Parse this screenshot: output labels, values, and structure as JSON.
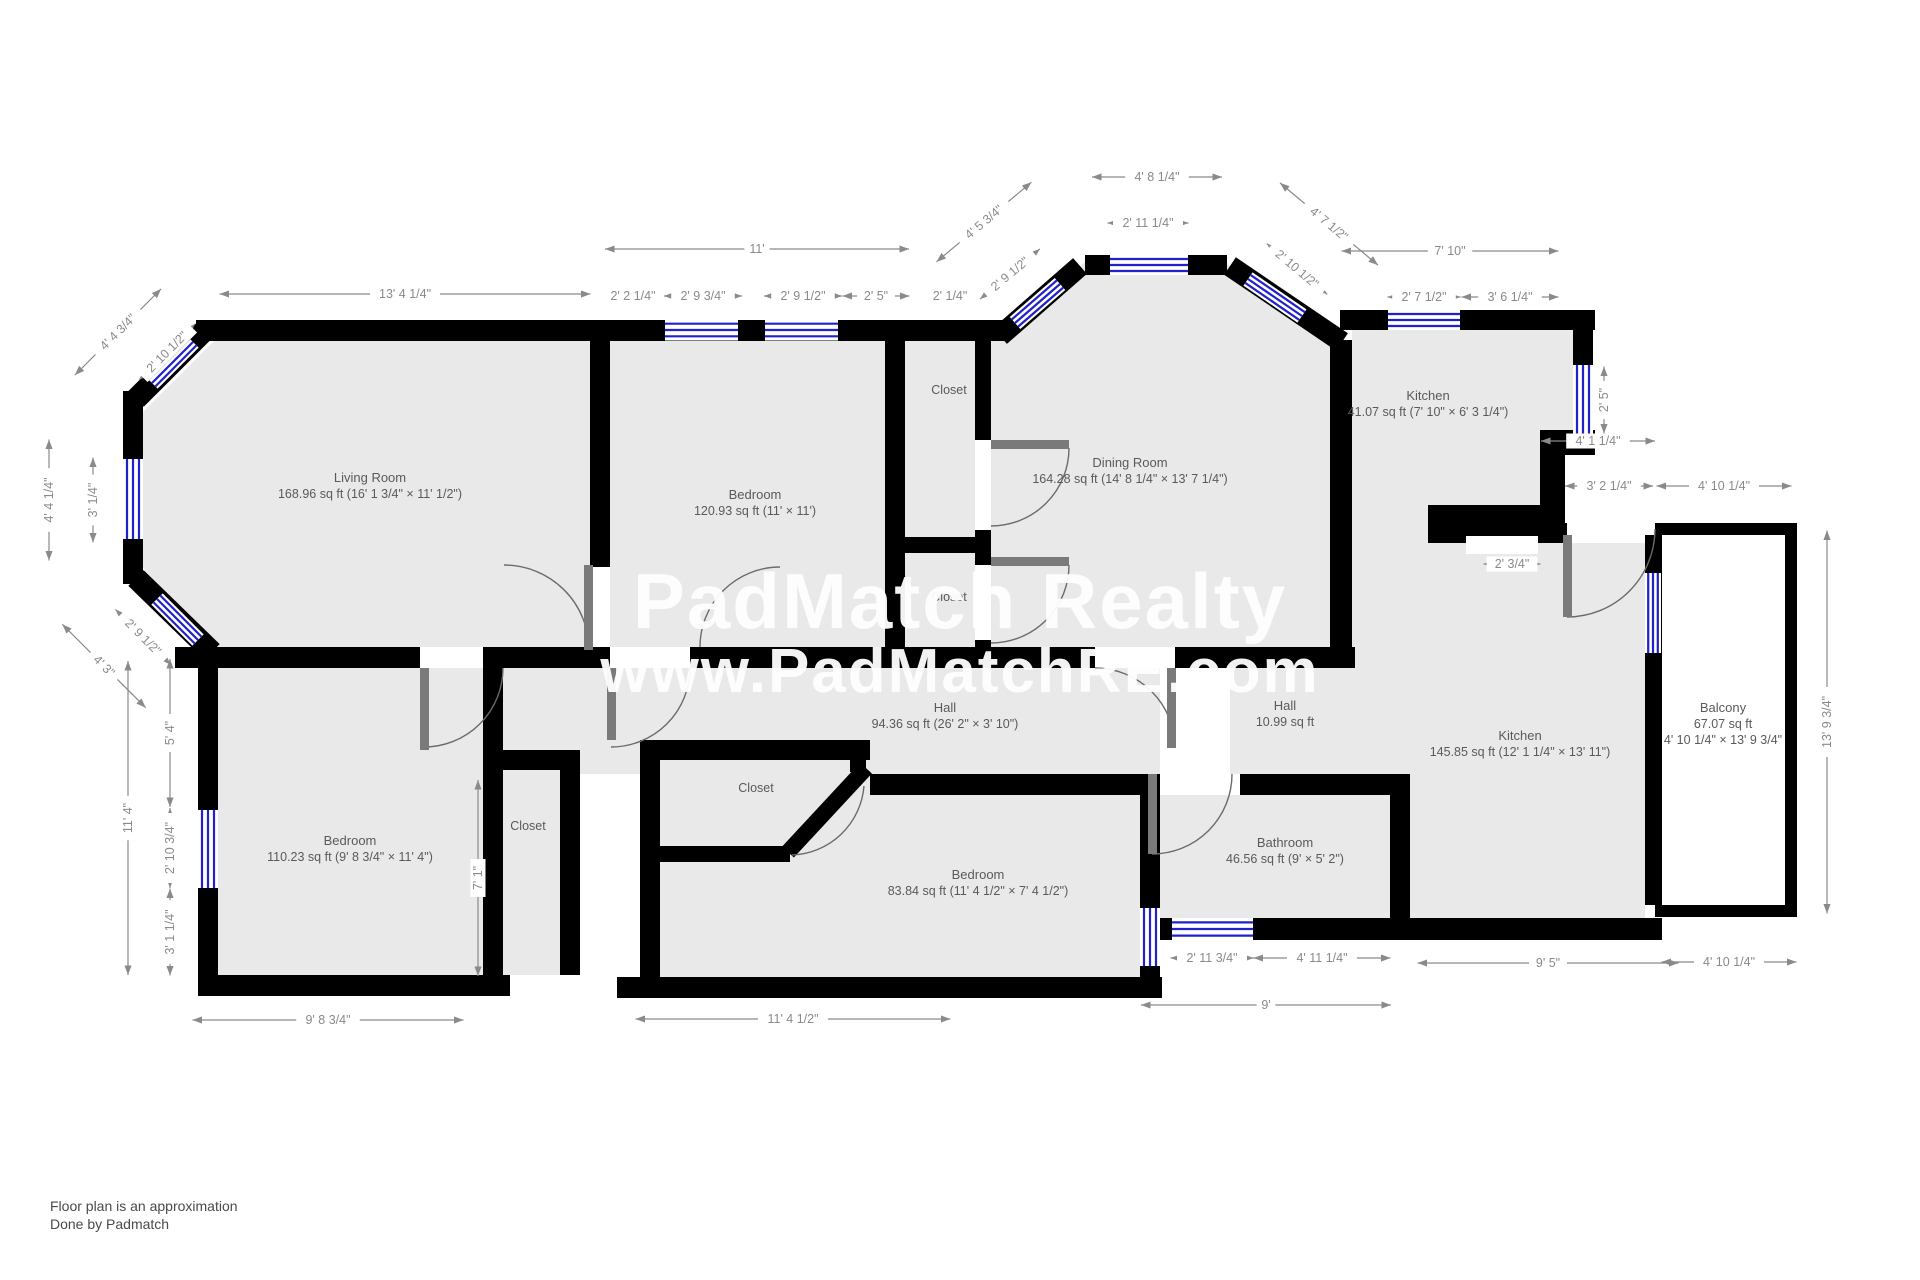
{
  "watermark": {
    "line1": "PadMatch Realty",
    "line2": "www.PadMatchRE.com"
  },
  "footer": {
    "line1": "Floor plan is an approximation",
    "line2": "Done by Padmatch"
  },
  "colors": {
    "wall": "#000000",
    "floor": "#e9e9e9",
    "window_blue": "#2121cc",
    "dimension_gray": "#8a8a8a",
    "label_gray": "#5a5a5a",
    "watermark_white": "#ffffff"
  },
  "rooms": [
    {
      "name": "Living Room",
      "area": "168.96 sq ft (16' 1 3/4\" × 11' 1/2\")",
      "x": 370,
      "y": 482
    },
    {
      "name": "Bedroom",
      "area": "120.93 sq ft (11' × 11')",
      "x": 755,
      "y": 499
    },
    {
      "name": "Dining Room",
      "area": "164.28 sq ft (14' 8 1/4\" × 13' 7 1/4\")",
      "x": 1130,
      "y": 467
    },
    {
      "name": "Kitchen",
      "area": "41.07 sq ft (7' 10\" × 6' 3 1/4\")",
      "x": 1428,
      "y": 400
    },
    {
      "name": "Kitchen",
      "area": "145.85 sq ft (12' 1 1/4\" × 13' 11\")",
      "x": 1520,
      "y": 740
    },
    {
      "name": "Balcony",
      "area": "67.07 sq ft",
      "area2": "4' 10 1/4\" × 13' 9 3/4\"",
      "x": 1723,
      "y": 712
    },
    {
      "name": "Hall",
      "area": "94.36 sq ft (26' 2\" × 3' 10\")",
      "x": 945,
      "y": 712
    },
    {
      "name": "Hall",
      "area": "10.99 sq ft",
      "x": 1285,
      "y": 710
    },
    {
      "name": "Bedroom",
      "area": "110.23 sq ft (9' 8 3/4\" × 11' 4\")",
      "x": 350,
      "y": 845
    },
    {
      "name": "Bedroom",
      "area": "83.84 sq ft (11' 4 1/2\" × 7' 4 1/2\")",
      "x": 978,
      "y": 879
    },
    {
      "name": "Bathroom",
      "area": "46.56 sq ft (9' × 5' 2\")",
      "x": 1285,
      "y": 847
    }
  ],
  "closets": [
    {
      "label": "Closet",
      "x": 949,
      "y": 394
    },
    {
      "label": "Closet",
      "x": 949,
      "y": 601
    },
    {
      "label": "Closet",
      "x": 528,
      "y": 830
    },
    {
      "label": "Closet",
      "x": 756,
      "y": 792
    }
  ],
  "dimensions": [
    {
      "label": "13' 4 1/4\"",
      "x": 405,
      "y": 294,
      "rot": 0,
      "len": 371
    },
    {
      "label": "11'",
      "x": 757,
      "y": 249,
      "rot": 0,
      "len": 304
    },
    {
      "label": "2' 2 1/4\"",
      "x": 633,
      "y": 296,
      "rot": 0,
      "len": 58
    },
    {
      "label": "2' 9 3/4\"",
      "x": 703,
      "y": 296,
      "rot": 0,
      "len": 78
    },
    {
      "label": "2' 9 1/2\"",
      "x": 803,
      "y": 296,
      "rot": 0,
      "len": 78
    },
    {
      "label": "2' 5\"",
      "x": 876,
      "y": 296,
      "rot": 0,
      "len": 67
    },
    {
      "label": "2' 1/4\"",
      "x": 950,
      "y": 296,
      "rot": 0,
      "len": 50
    },
    {
      "label": "4' 5 3/4\"",
      "x": 984,
      "y": 222,
      "rot": -40,
      "len": 124
    },
    {
      "label": "2' 9 1/2\"",
      "x": 1010,
      "y": 274,
      "rot": -40,
      "len": 78
    },
    {
      "label": "4' 8 1/4\"",
      "x": 1157,
      "y": 177,
      "rot": 0,
      "len": 130
    },
    {
      "label": "2' 11 1/4\"",
      "x": 1148,
      "y": 223,
      "rot": 0,
      "len": 81
    },
    {
      "label": "4' 7 1/2\"",
      "x": 1329,
      "y": 224,
      "rot": 40,
      "len": 128
    },
    {
      "label": "2' 10 1/2\"",
      "x": 1297,
      "y": 269,
      "rot": 40,
      "len": 79
    },
    {
      "label": "7' 10\"",
      "x": 1450,
      "y": 251,
      "rot": 0,
      "len": 217
    },
    {
      "label": "2' 7 1/2\"",
      "x": 1424,
      "y": 297,
      "rot": 0,
      "len": 73
    },
    {
      "label": "3' 6 1/4\"",
      "x": 1510,
      "y": 297,
      "rot": 0,
      "len": 97
    },
    {
      "label": "2' 5\"",
      "x": 1604,
      "y": 400,
      "rot": -90,
      "len": 67
    },
    {
      "label": "4' 1 1/4\"",
      "x": 1598,
      "y": 441,
      "rot": 0,
      "len": 114
    },
    {
      "label": "3' 2 1/4\"",
      "x": 1609,
      "y": 486,
      "rot": 0,
      "len": 88
    },
    {
      "label": "4' 10 1/4\"",
      "x": 1724,
      "y": 486,
      "rot": 0,
      "len": 135
    },
    {
      "label": "2' 3/4\"",
      "x": 1512,
      "y": 564,
      "rot": 0,
      "len": 57
    },
    {
      "label": "13' 9 3/4\"",
      "x": 1827,
      "y": 722,
      "rot": -90,
      "len": 383
    },
    {
      "label": "4' 4 3/4\"",
      "x": 118,
      "y": 332,
      "rot": -45,
      "len": 122
    },
    {
      "label": "2' 10 1/2\"",
      "x": 167,
      "y": 352,
      "rot": -45,
      "len": 79
    },
    {
      "label": "4' 4 1/4\"",
      "x": 49,
      "y": 500,
      "rot": -90,
      "len": 121
    },
    {
      "label": "3' 1/4\"",
      "x": 93,
      "y": 500,
      "rot": -90,
      "len": 85
    },
    {
      "label": "2' 9 1/2\"",
      "x": 143,
      "y": 637,
      "rot": 45,
      "len": 78
    },
    {
      "label": "4' 3\"",
      "x": 104,
      "y": 666,
      "rot": 45,
      "len": 118
    },
    {
      "label": "5' 4\"",
      "x": 170,
      "y": 733,
      "rot": -90,
      "len": 148
    },
    {
      "label": "11' 4\"",
      "x": 128,
      "y": 818,
      "rot": -90,
      "len": 314
    },
    {
      "label": "2' 10 3/4\"",
      "x": 170,
      "y": 848,
      "rot": -90,
      "len": 80
    },
    {
      "label": "3' 1 1/4\"",
      "x": 170,
      "y": 932,
      "rot": -90,
      "len": 87
    },
    {
      "label": "7' 1\"",
      "x": 478,
      "y": 878,
      "rot": -90,
      "len": 196
    },
    {
      "label": "9' 8 3/4\"",
      "x": 328,
      "y": 1020,
      "rot": 0,
      "len": 271
    },
    {
      "label": "11' 4 1/2\"",
      "x": 793,
      "y": 1019,
      "rot": 0,
      "len": 315
    },
    {
      "label": "2' 11 3/4\"",
      "x": 1212,
      "y": 958,
      "rot": 0,
      "len": 83
    },
    {
      "label": "4' 11 1/4\"",
      "x": 1322,
      "y": 958,
      "rot": 0,
      "len": 137
    },
    {
      "label": "9'",
      "x": 1266,
      "y": 1005,
      "rot": 0,
      "len": 250
    },
    {
      "label": "9' 5\"",
      "x": 1548,
      "y": 963,
      "rot": 0,
      "len": 261
    },
    {
      "label": "4' 10 1/4\"",
      "x": 1729,
      "y": 962,
      "rot": 0,
      "len": 135
    }
  ]
}
